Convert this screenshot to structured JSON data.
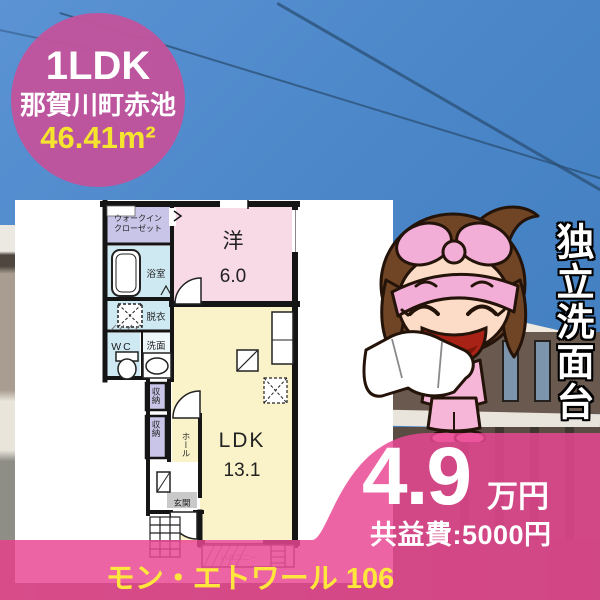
{
  "badge": {
    "layout_type": "1LDK",
    "location": "那賀川町赤池",
    "area": "46.41m²"
  },
  "feature_banner": {
    "text": "独立洗面台"
  },
  "pricing": {
    "rent_amount": "4.9",
    "rent_unit": "万円",
    "common_fee": "共益費:5000円"
  },
  "property": {
    "name": "モン・エトワール 106"
  },
  "floorplan": {
    "walk_in_closet_line1": "ウォークイン",
    "walk_in_closet_line2": "クローゼット",
    "bathroom": "浴室",
    "dressing_room": "脱衣",
    "toilet": "WC",
    "washstand": "洗面",
    "western_room": "洋",
    "western_room_size": "6.0",
    "ldk": "LDK",
    "ldk_size": "13.1",
    "storage_1": "収納",
    "storage_2": "収納",
    "hall": "ホール",
    "entrance": "玄関",
    "balcony": "バルコニー"
  },
  "colors": {
    "badge_pink": "#c0549c",
    "accent_pink_overlay": "#e9488f",
    "highlight_yellow": "#f6e52e",
    "name_yellow": "#ffe63c",
    "room_pink": "#f8d9e6",
    "room_yellow": "#faf3c9",
    "room_lavender": "#c9c5e8",
    "room_blue": "#cfe9f2",
    "sky_blue": "#4a86c8"
  }
}
